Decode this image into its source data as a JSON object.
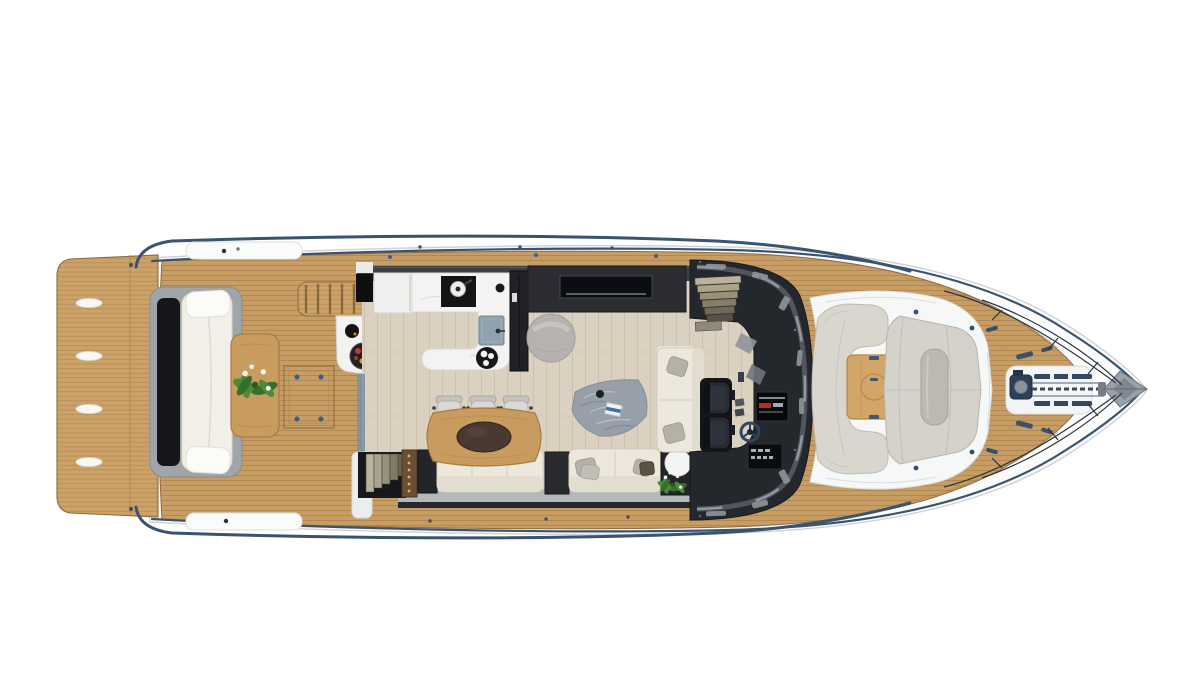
{
  "scene": {
    "kind": "yacht-deck-plan-render",
    "view": "top-down",
    "orientation": "bow-right"
  },
  "palette": {
    "background": "#ffffff",
    "hull": "#fcfcfd",
    "hulledge": "#ced2d6",
    "navy": "#3a536e",
    "navydark": "#2c4158",
    "teak": "#c89d63",
    "teakborder": "#8c6a3c",
    "teakseam": "#9c7746",
    "platform": "#cda268",
    "floor": "#dad1c0",
    "floorseam": "#b3a78d",
    "charcoal": "#24272c",
    "charcoalsoft": "#3c3f44",
    "black": "#0e0f10",
    "marble": "#f4f3f1",
    "marbleedge": "#d8d8d5",
    "cream": "#ece8db",
    "creamedge": "#d2ccbc",
    "creamdark": "#e2ddcf",
    "greige": "#d9d6ce",
    "greigeedge": "#bfbbb1",
    "sunpad": "#d4d2cb",
    "sunpadseam": "#b8b5ad",
    "bolster": "#bcb9b2",
    "graycushion": "#b5b1a9",
    "sill": "#b4b8bb",
    "woodtable": "#c89b5e",
    "woodedge": "#a67c45",
    "beanbag": "#b6b2af",
    "rug": "#97a0a8",
    "sinkblue": "#8fa2ae",
    "screen": "#0a0b0c",
    "accentred": "#b33027",
    "steel": "#9aa2ab",
    "plantgreen": "#4a8a38",
    "plantdark": "#35702a"
  },
  "regions": {
    "hull": {
      "label": "yacht hull top view"
    },
    "swim_platform": {
      "label": "teak swim platform with four recessed handles"
    },
    "transom_seat": {
      "label": "transom bench seat with white cushion"
    },
    "aft_table": {
      "label": "aft deck teak table with plant"
    },
    "engine_hatch": {
      "label": "aft deck engine hatch with latches"
    },
    "flybridge_stairs": {
      "label": "teak steps to flybridge"
    },
    "wet_bar": {
      "label": "aft deck wet bar with fruit platter"
    },
    "galley": {
      "label": "galley with cooktop and sink"
    },
    "fridge": {
      "label": "tall galley cabinet"
    },
    "tv_cabinet": {
      "label": "salon sideboard cabinet"
    },
    "bean_bag": {
      "label": "round lounge pouf"
    },
    "dining_table": {
      "label": "salon dining table"
    },
    "dining_chairs": {
      "label": "three dining chairs"
    },
    "bench_sofa": {
      "label": "salon bench sofa"
    },
    "side_sofa": {
      "label": "forward facing sofa with pillows"
    },
    "chaise_sofa": {
      "label": "athwartships sofa with pillows"
    },
    "corner_table": {
      "label": "corner unit with round table and plant"
    },
    "rug": {
      "label": "gray throw blanket with book"
    },
    "stairwell_down": {
      "label": "stairs down to cabins"
    },
    "companionway": {
      "label": "companionway steps"
    },
    "windshield": {
      "label": "wraparound windshield"
    },
    "helm": {
      "label": "helm station with displays and wheel"
    },
    "helm_seats": {
      "label": "two helm seats"
    },
    "bow_settee": {
      "label": "bow cockpit settee"
    },
    "bow_table": {
      "label": "bow cockpit teak table"
    },
    "bow_sunpad": {
      "label": "bow sunpad with bolster"
    },
    "windlass": {
      "label": "anchor windlass"
    },
    "anchor": {
      "label": "anchor at bow tip"
    },
    "foredeck": {
      "label": "teak foredeck"
    },
    "rails": {
      "label": "bow rails and rub rail"
    }
  }
}
